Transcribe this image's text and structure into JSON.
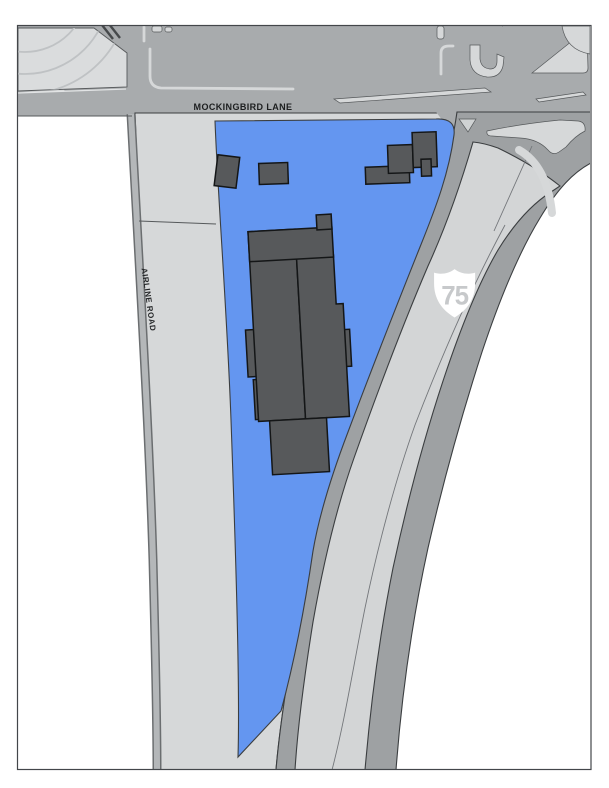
{
  "map": {
    "title": "site-plan-map",
    "labels": {
      "street_top": "MOCKINGBIRD LANE",
      "street_left": "AIRLINE ROAD",
      "highway_number": "75"
    },
    "colors": {
      "parcel_blue": "#6496F0",
      "road_gray": "#A8ABAD",
      "light_gray": "#D6D8D9",
      "shoulder_gray": "#9EA1A3",
      "lane_gray": "#D3D5D6",
      "building_gray": "#57595B",
      "shield_fill": "#FFFFFF",
      "shield_digits": "#C7C9CB",
      "frame_border": "#43464A"
    }
  }
}
